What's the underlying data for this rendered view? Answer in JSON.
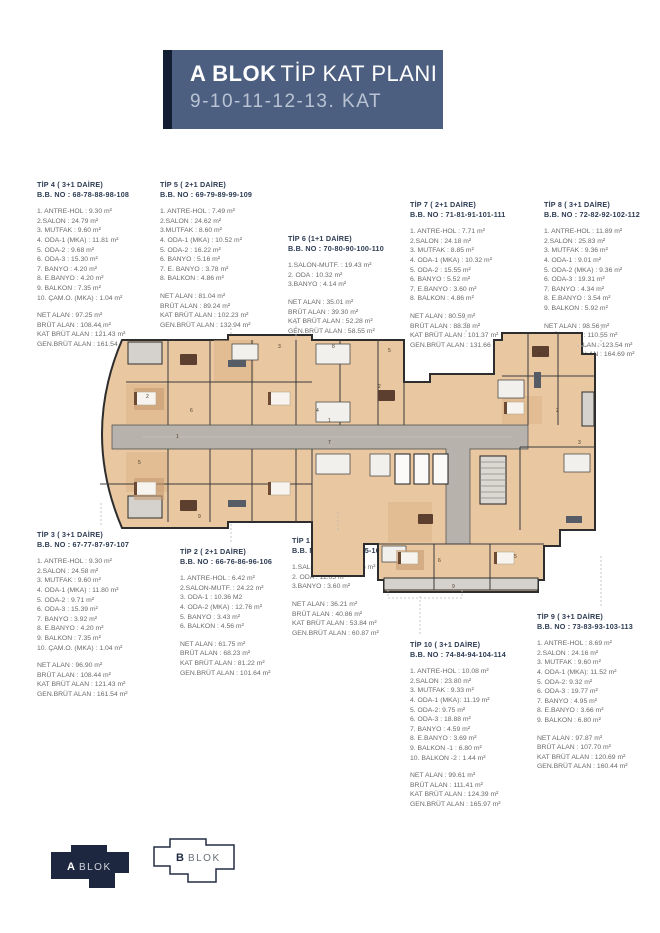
{
  "header": {
    "block": "A BLOK",
    "title": "TİP KAT PLANI",
    "subtitle": "9-10-11-12-13. KAT"
  },
  "colors": {
    "header_bg": "#4d5f80",
    "header_dark": "#141e33",
    "navy": "#1d2840",
    "title": "#2c3a52",
    "text": "#6a6a6a",
    "plan_tan": "#e9c7a0",
    "corridor": "#b7b3ac"
  },
  "units": [
    {
      "title": "TİP 4 ( 3+1 DAİRE)",
      "bb_no": "B.B. NO : 68-78-88-98-108",
      "rooms": [
        "1. ANTRE-HOL : 9.30 m²",
        "2.SALON : 24.79 m²",
        "3. MUTFAK : 9.60 m²",
        "4. ODA-1 (MKA) : 11.81 m²",
        "5. ODA-2 : 9.68 m²",
        "6. ODA-3 : 15.30 m²",
        "7. BANYO : 4.20 m²",
        "8. E.BANYO : 4.20 m²",
        "9. BALKON : 7.35 m²",
        "10. ÇAM.O. (MKA) : 1.04 m²"
      ],
      "totals": [
        "NET ALAN : 97.25 m²",
        "BRÜT ALAN : 108.44 m²",
        "KAT BRÜT ALAN : 121.43 m²",
        "GEN.BRÜT ALAN : 161.54 m²"
      ]
    },
    {
      "title": "TİP 5 ( 2+1 DAİRE)",
      "bb_no": "B.B. NO : 69-79-89-99-109",
      "rooms": [
        "1. ANTRE-HOL : 7.49 m²",
        "2.SALON : 24.62 m²",
        "3.MUTFAK : 8.60 m²",
        "4. ODA-1 (MKA) : 10.52 m²",
        "5. ODA-2 : 16.22 m²",
        "6. BANYO : 5.16 m²",
        "7. E. BANYO : 3.78 m²",
        "8. BALKON : 4.86 m²"
      ],
      "totals": [
        "NET ALAN : 81.04 m²",
        "BRÜT ALAN : 89.24 m²",
        "KAT BRÜT ALAN : 102.23 m²",
        "GEN.BRÜT ALAN : 132.94 m²"
      ]
    },
    {
      "title": "TİP 6 (1+1 DAİRE)",
      "bb_no": "B.B. NO : 70-80-90-100-110",
      "rooms": [
        "1.SALON-MUTF. : 19.43 m²",
        "2. ODA : 10.32 m²",
        "3.BANYO : 4.14 m²"
      ],
      "totals": [
        "NET ALAN : 35.01 m²",
        "BRÜT ALAN : 39.30 m²",
        "KAT BRÜT ALAN : 52.28 m²",
        "GEN.BRÜT ALAN : 58.55 m²"
      ]
    },
    {
      "title": "TİP 7 ( 2+1 DAİRE)",
      "bb_no": "B.B. NO : 71-81-91-101-111",
      "rooms": [
        "1. ANTRE-HOL : 7.71 m²",
        "2.SALON : 24.18 m²",
        "3. MUTFAK : 8.85 m²",
        "4. ODA-1 (MKA) : 10.32 m²",
        "5. ODA-2 : 15.55 m²",
        "6. BANYO : 5.52 m²",
        "7. E.BANYO : 3.60 m²",
        "8. BALKON : 4.86 m²"
      ],
      "totals": [
        "NET ALAN : 80.59 m²",
        "BRÜT ALAN : 88.38 m²",
        "KAT BRÜT ALAN : 101.37 m²",
        "GEN.BRÜT ALAN : 131.66 m²"
      ]
    },
    {
      "title": "TİP 8 ( 3+1 DAİRE)",
      "bb_no": "B.B. NO : 72-82-92-102-112",
      "rooms": [
        "1. ANTRE-HOL : 11.89 m²",
        "2.SALON : 25.83 m²",
        "3. MUTFAK : 9.36 m²",
        "4. ODA-1 : 9.01 m²",
        "5. ODA-2 (MKA) : 9.36 m²",
        "6. ODA-3 : 19.31 m²",
        "7. BANYO : 4.34 m²",
        "8. E.BANYO : 3.54 m²",
        "9. BALKON : 5.92 m²"
      ],
      "totals": [
        "NET ALAN : 98.56 m²",
        "BRÜT ALAN : 110.55 m²",
        "KAT BRÜT ALAN : 123.54 m²",
        "GEN.BRÜT ALAN : 164.69 m²"
      ]
    },
    {
      "title": "TİP 3 ( 3+1 DAİRE)",
      "bb_no": "B.B. NO : 67-77-87-97-107",
      "rooms": [
        "1. ANTRE-HOL : 9.30 m²",
        "2.SALON : 24.58 m²",
        "3. MUTFAK : 9.60 m²",
        "4. ODA-1 (MKA) : 11.80 m²",
        "5. ODA-2 : 9.71 m²",
        "6. ODA-3 : 15.39 m²",
        "7. BANYO : 3.92 m²",
        "8. E.BANYO : 4.20 m²",
        "9. BALKON : 7.35 m²",
        "10. ÇAM.O. (MKA) : 1.04 m²"
      ],
      "totals": [
        "NET ALAN : 96.90 m²",
        "BRÜT ALAN : 108.44 m²",
        "KAT BRÜT ALAN : 121.43 m²",
        "GEN.BRÜT ALAN : 161.54 m²"
      ]
    },
    {
      "title": "TİP 2 ( 2+1 DAİRE)",
      "bb_no": "B.B. NO : 66-76-86-96-106",
      "rooms": [
        "1. ANTRE-HOL : 6.42 m²",
        "2.SALON-MUTF. : 24.22 m²",
        "3. ODA-1 : 10.36 M2",
        "4. ODA-2 (MKA) : 12.76 m²",
        "5. BANYO : 3.43 m²",
        "6. BALKON : 4.56 m²"
      ],
      "totals": [
        "NET ALAN : 61.75 m²",
        "BRÜT ALAN : 68.23 m²",
        "KAT BRÜT ALAN : 81.22 m²",
        "GEN.BRÜT ALAN : 101.64 m²"
      ]
    },
    {
      "title": "TİP 1 (1+1 DAİRE)",
      "bb_no": "B.B. NO : 65-75-85-95-105",
      "rooms": [
        "1.SALON-MUTF. : 21.56 m²",
        "2. ODA : 11.05 m²",
        "3.BANYO : 3.60 m²"
      ],
      "totals": [
        "NET ALAN : 36.21 m²",
        "BRÜT ALAN : 40.86 m²",
        "KAT BRÜT ALAN : 53.84 m²",
        "GEN.BRÜT ALAN : 60.87 m²"
      ]
    },
    {
      "title": "TİP 10 ( 3+1 DAİRE)",
      "bb_no": "B.B. NO : 74-84-94-104-114",
      "rooms": [
        "1. ANTRE-HOL : 10.08 m²",
        "2.SALON : 23.80 m²",
        "3. MUTFAK : 9.33 m²",
        "4. ODA-1 (MKA): 11.19 m²",
        "5. ODA-2: 9.75 m²",
        "6. ODA-3 : 18.88 m²",
        "7. BANYO : 4.59 m²",
        "8. E.BANYO : 3.69 m²",
        "9. BALKON -1 : 6.80 m²",
        "10. BALKON -2 : 1.44 m²"
      ],
      "totals": [
        "NET ALAN : 99.61 m²",
        "BRÜT ALAN : 111.41 m²",
        "KAT BRÜT ALAN : 124.39 m²",
        "GEN.BRÜT ALAN : 165.97 m²"
      ]
    },
    {
      "title": "TİP 9 ( 3+1 DAİRE)",
      "bb_no": "B.B. NO : 73-83-93-103-113",
      "rooms": [
        "1. ANTRE-HOL : 8.69 m²",
        "2.SALON : 24.16 m²",
        "3. MUTFAK : 9.60 m²",
        "4. ODA-1 (MKA): 11.52 m²",
        "5. ODA-2: 9.32 m²",
        "6. ODA-3 : 19.77 m²",
        "7. BANYO : 4.95 m²",
        "8. E.BANYO : 3.66 m²",
        "9. BALKON : 6.80 m²"
      ],
      "totals": [
        "NET ALAN : 97.87 m²",
        "BRÜT ALAN : 107.70 m²",
        "KAT BRÜT ALAN : 120.69 m²",
        "GEN.BRÜT ALAN : 160.44 m²"
      ]
    }
  ],
  "plan": {
    "labels": [
      {
        "t": "2",
        "x": 64,
        "y": 66
      },
      {
        "t": "5",
        "x": 56,
        "y": 132
      },
      {
        "t": "6",
        "x": 108,
        "y": 80
      },
      {
        "t": "3",
        "x": 196,
        "y": 16
      },
      {
        "t": "8",
        "x": 250,
        "y": 16
      },
      {
        "t": "1",
        "x": 246,
        "y": 90
      },
      {
        "t": "7",
        "x": 246,
        "y": 112
      },
      {
        "t": "4",
        "x": 234,
        "y": 80
      },
      {
        "t": "2",
        "x": 296,
        "y": 56
      },
      {
        "t": "5",
        "x": 306,
        "y": 20
      },
      {
        "t": "6",
        "x": 456,
        "y": 24
      },
      {
        "t": "2",
        "x": 474,
        "y": 80
      },
      {
        "t": "3",
        "x": 496,
        "y": 112
      },
      {
        "t": "2",
        "x": 316,
        "y": 232
      },
      {
        "t": "6",
        "x": 356,
        "y": 230
      },
      {
        "t": "9",
        "x": 370,
        "y": 256
      },
      {
        "t": "5",
        "x": 432,
        "y": 226
      },
      {
        "t": "1",
        "x": 94,
        "y": 106
      },
      {
        "t": "9",
        "x": 116,
        "y": 186
      }
    ]
  },
  "footer": {
    "blocks": [
      {
        "letter": "A",
        "word": "BLOK",
        "active": true
      },
      {
        "letter": "B",
        "word": "BLOK",
        "active": false
      }
    ]
  }
}
